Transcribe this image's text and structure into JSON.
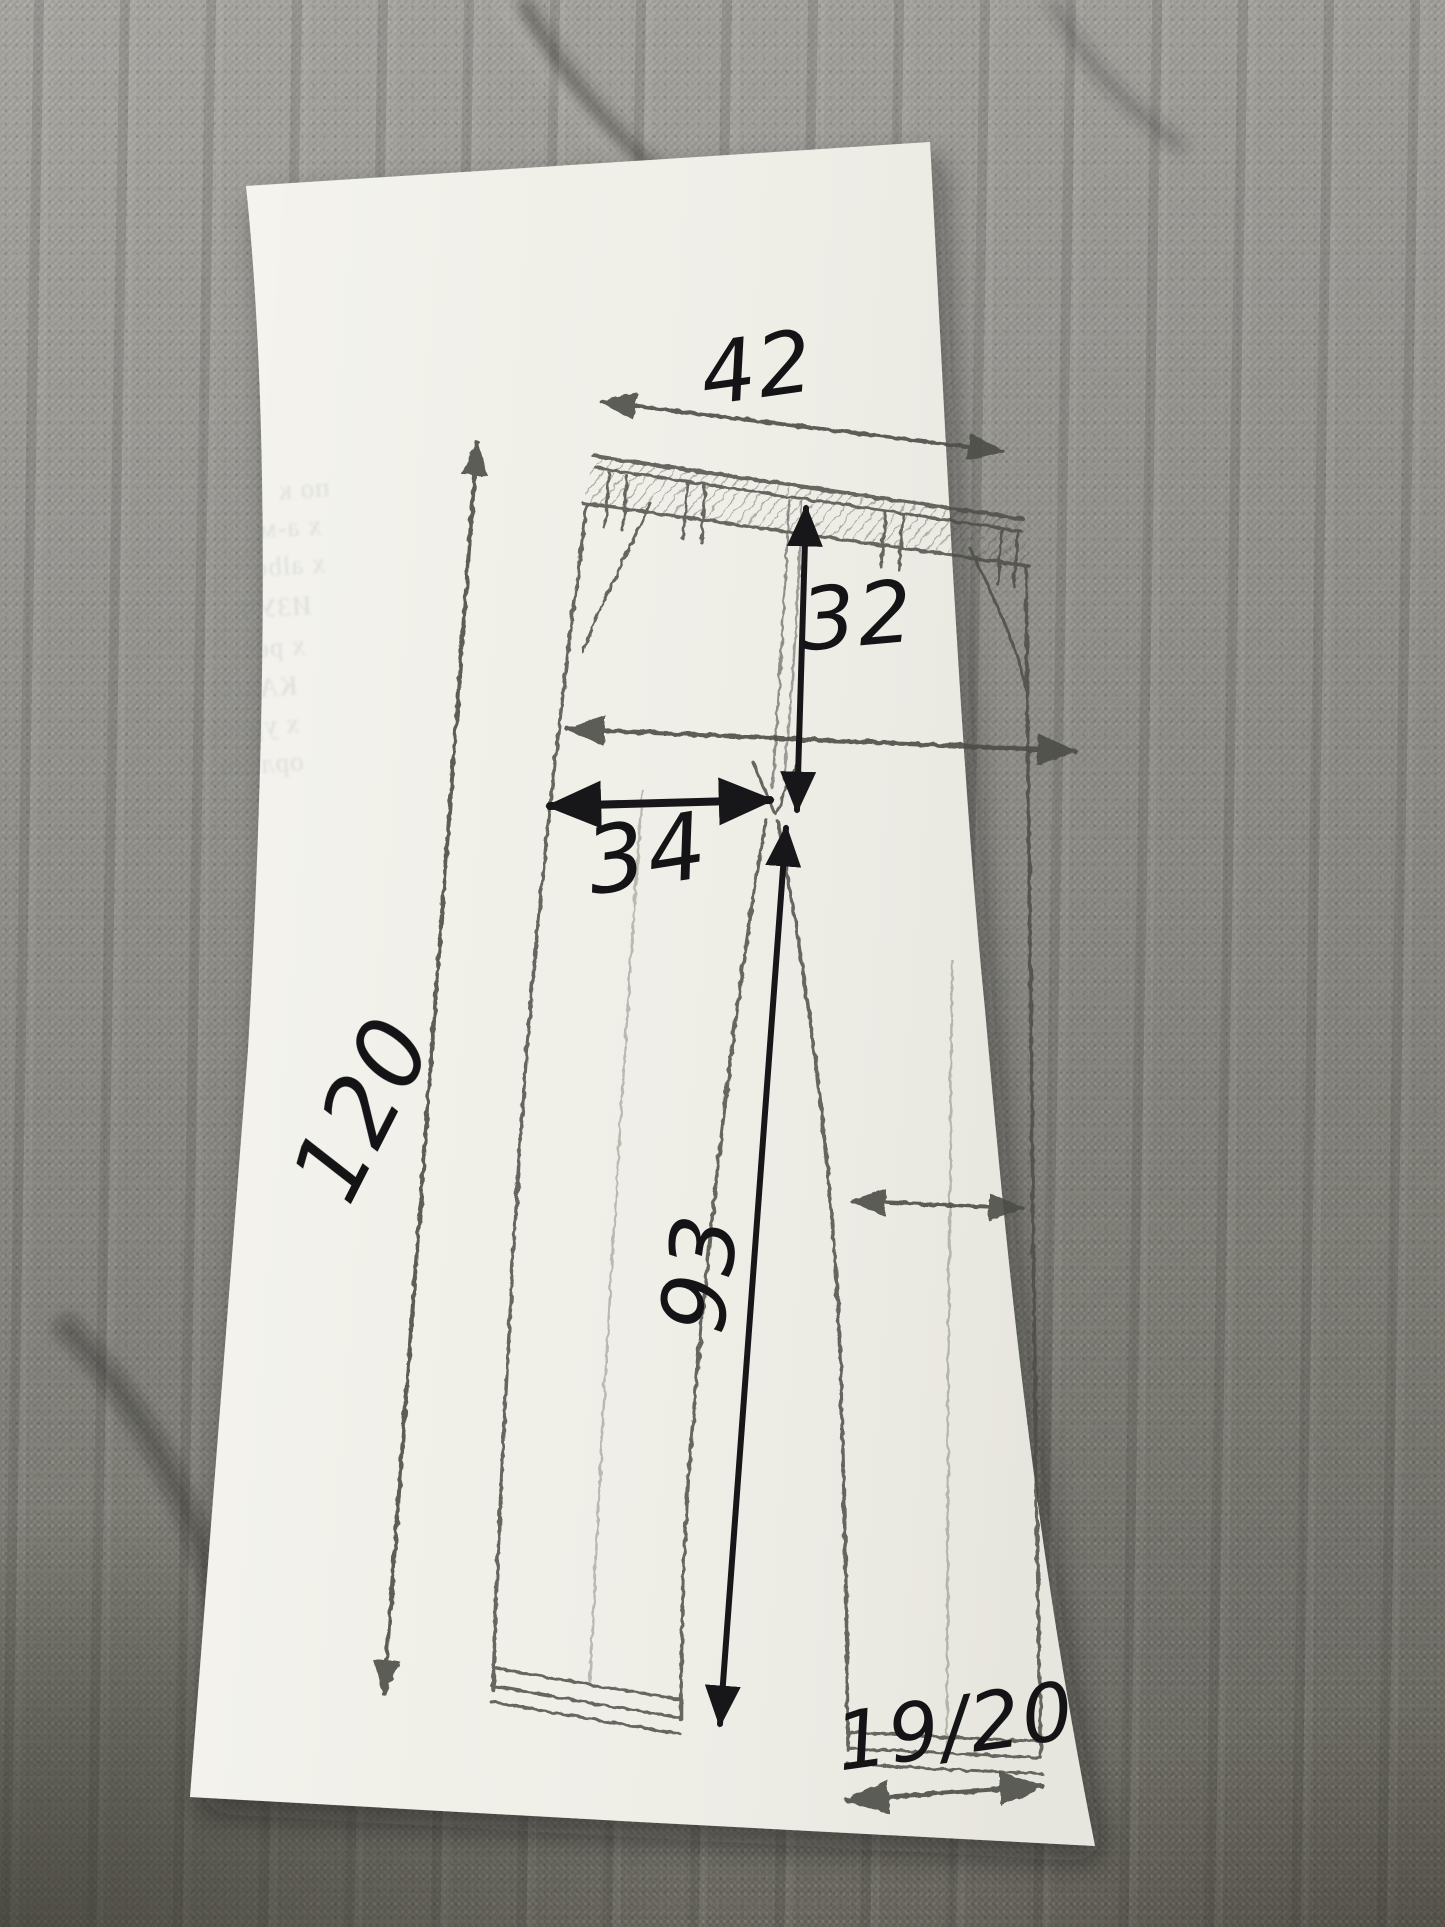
{
  "diagram": {
    "labels": {
      "waist_width": "42",
      "front_rise": "32",
      "hip_width": "34",
      "side_length": "120",
      "inseam": "93",
      "leg_opening": "19/20"
    },
    "ghost_text": [
      "по к",
      "х а-м",
      "х albo",
      "ИЗУЧ",
      "х рес",
      "КАЗН",
      "х урес",
      "орлеан"
    ]
  },
  "colors": {
    "pen": "#17171a",
    "pencil": "#4e4d47",
    "paper": "#f0efe8",
    "fabric": "#8b8a85"
  }
}
